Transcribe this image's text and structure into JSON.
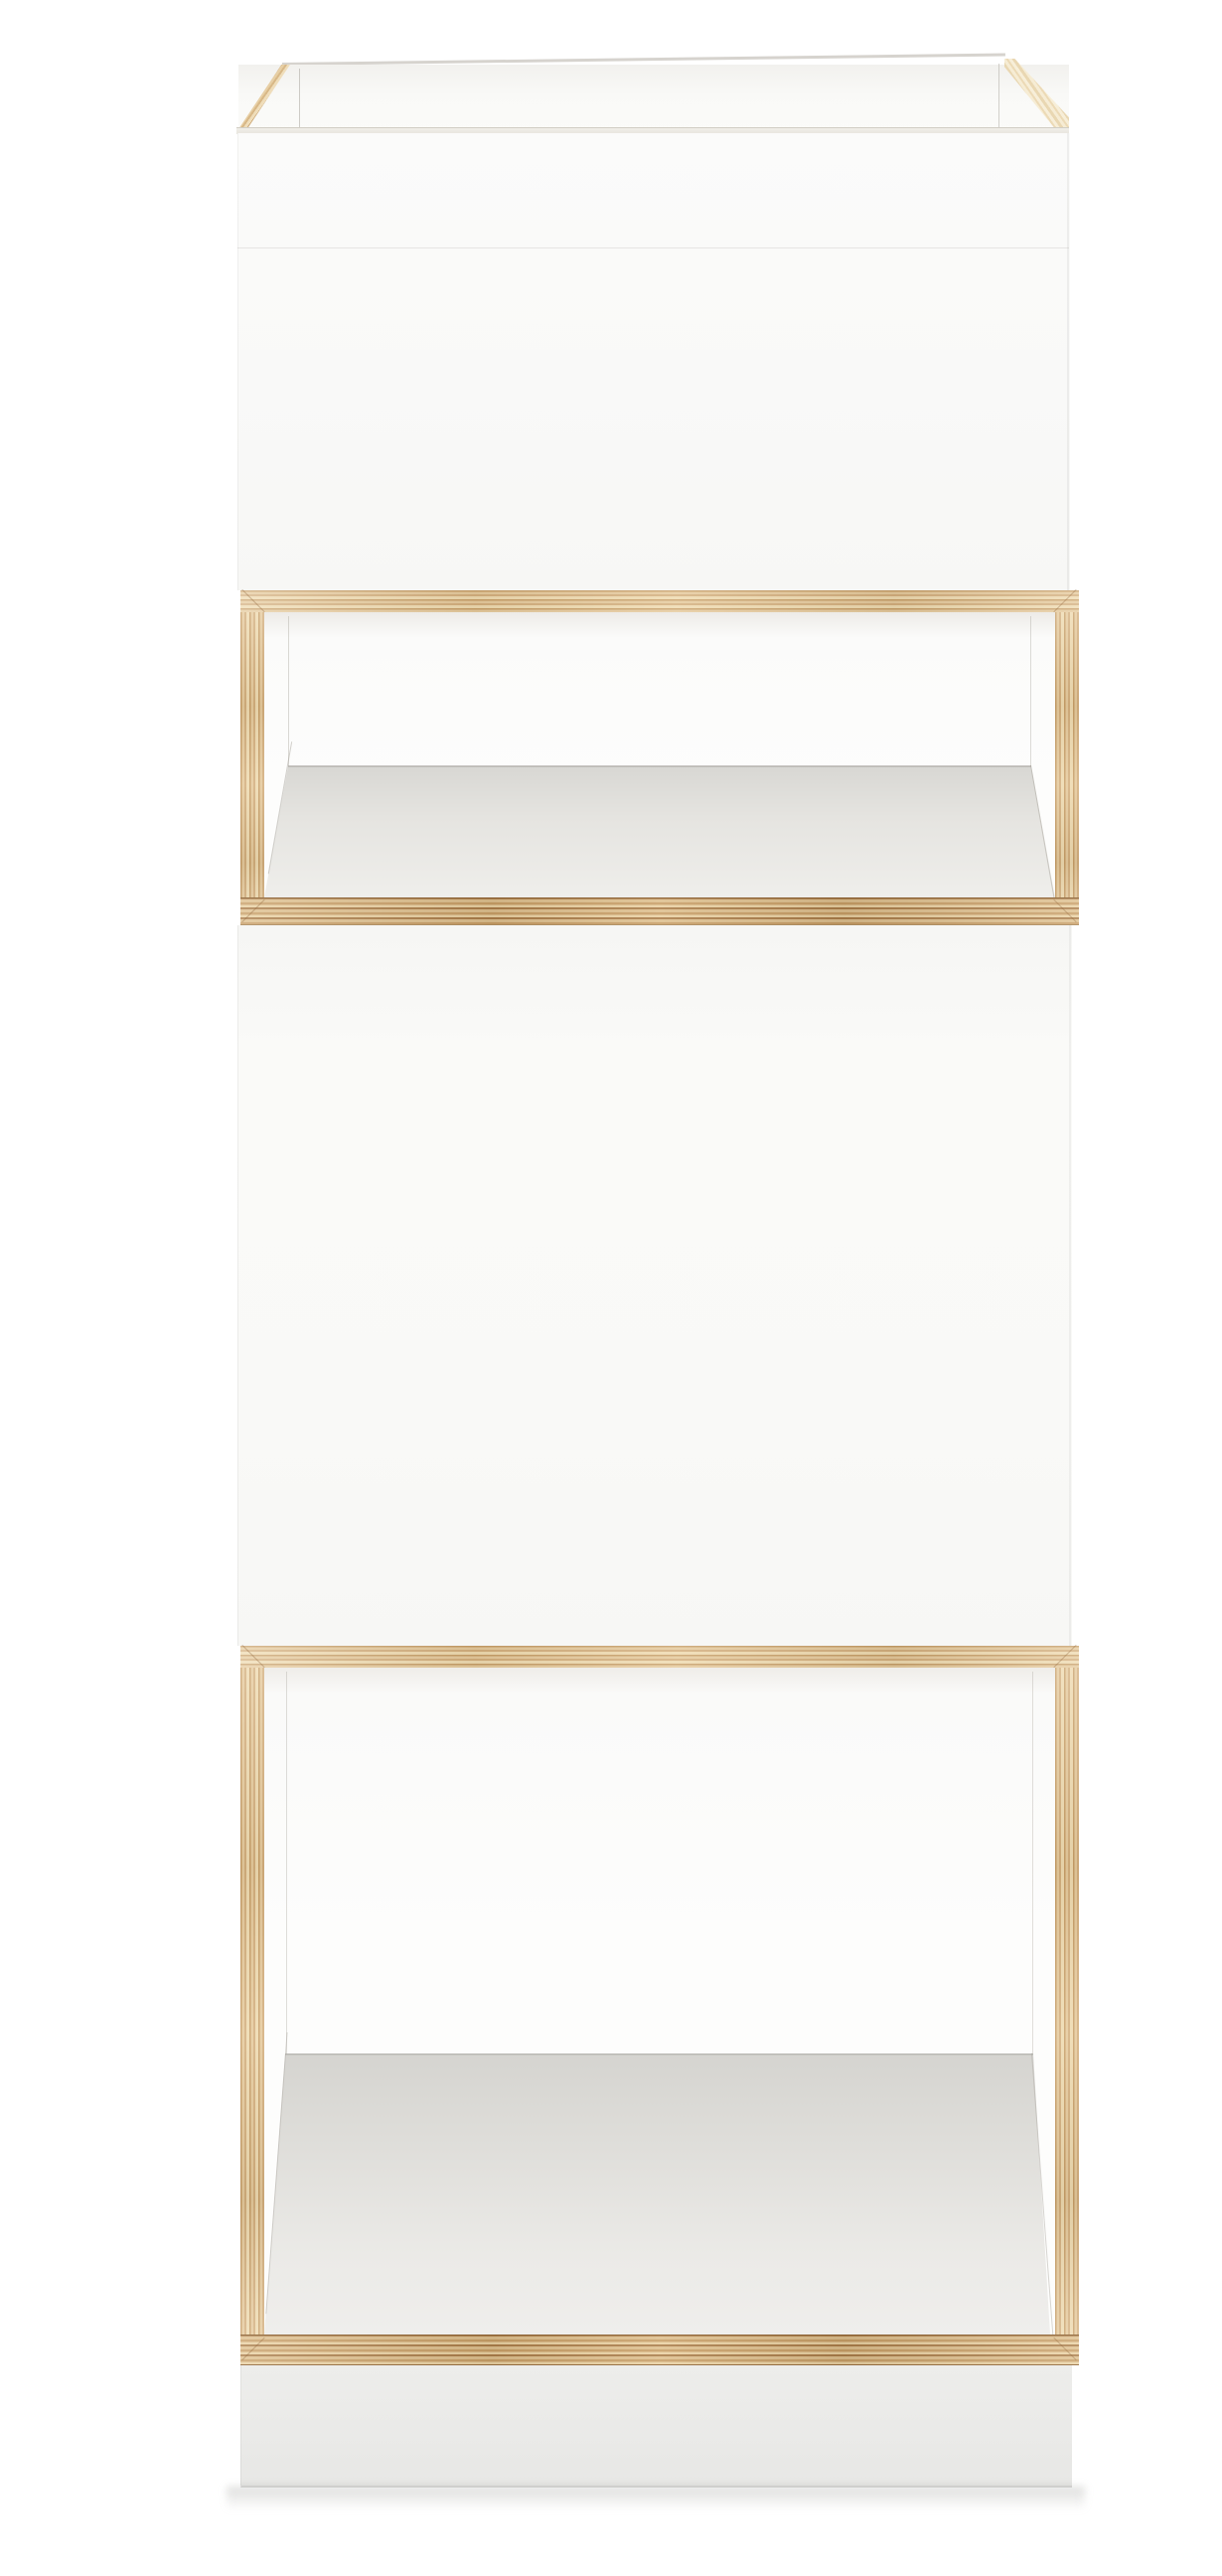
{
  "photo": {
    "subject": "Tall narrow white shelf tower with exposed birch plywood edges, front view on white background",
    "background_color": "#ffffff",
    "sections": [
      {
        "id": "top-open-box",
        "label": "open-top storage box with white front and plywood top edges"
      },
      {
        "id": "open-shelf",
        "label": "small open shelf compartment framed in plywood"
      },
      {
        "id": "closed-front",
        "label": "tall closed white front panel"
      },
      {
        "id": "open-compartment",
        "label": "large open compartment framed in plywood"
      },
      {
        "id": "plinth",
        "label": "recessed white plinth base above floor shadow"
      }
    ]
  },
  "palette": {
    "bg": "#ffffff",
    "front": "#fafaf9",
    "front-deep": "#f5f5f3",
    "wood": "#d9bb8e",
    "wood-dark": "#b88a55",
    "wood-light": "#ecd8b0",
    "wood-band": "#cda571",
    "wood-band-dark": "#a87c48",
    "wood-glance": "#ecdab6",
    "floor-back": "#d6d5d1",
    "floor-front": "#efeeec",
    "plinth": "#eaeae8",
    "line": "#d6d3ce"
  }
}
